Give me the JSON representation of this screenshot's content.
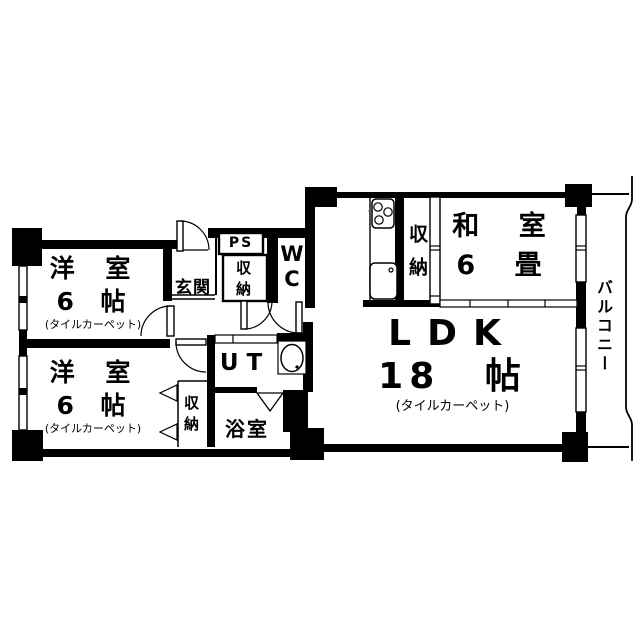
{
  "rooms": {
    "western_top": {
      "name": "洋 室",
      "size": "6 帖",
      "finish": "(タイルカーペット)"
    },
    "western_bottom": {
      "name": "洋 室",
      "size": "6 帖",
      "finish": "(タイルカーペット)"
    },
    "japanese": {
      "name": "和 室",
      "size": "6 畳"
    },
    "ldk": {
      "name": "LDK",
      "size": "18 帖",
      "finish": "(タイルカーペット)"
    },
    "entrance": {
      "label": "玄関"
    },
    "pipe_space": {
      "label": "PS"
    },
    "hall_closet": {
      "label": "収納"
    },
    "wc": {
      "label": "WC"
    },
    "kitchen_closet": {
      "label": "収納"
    },
    "bedroom_closet": {
      "label": "収納"
    },
    "utility": {
      "label": "UT"
    },
    "bathroom": {
      "label": "浴室"
    },
    "balcony": {
      "label": "バルコニー"
    }
  },
  "colors": {
    "wall": "#000000",
    "background": "#ffffff"
  }
}
